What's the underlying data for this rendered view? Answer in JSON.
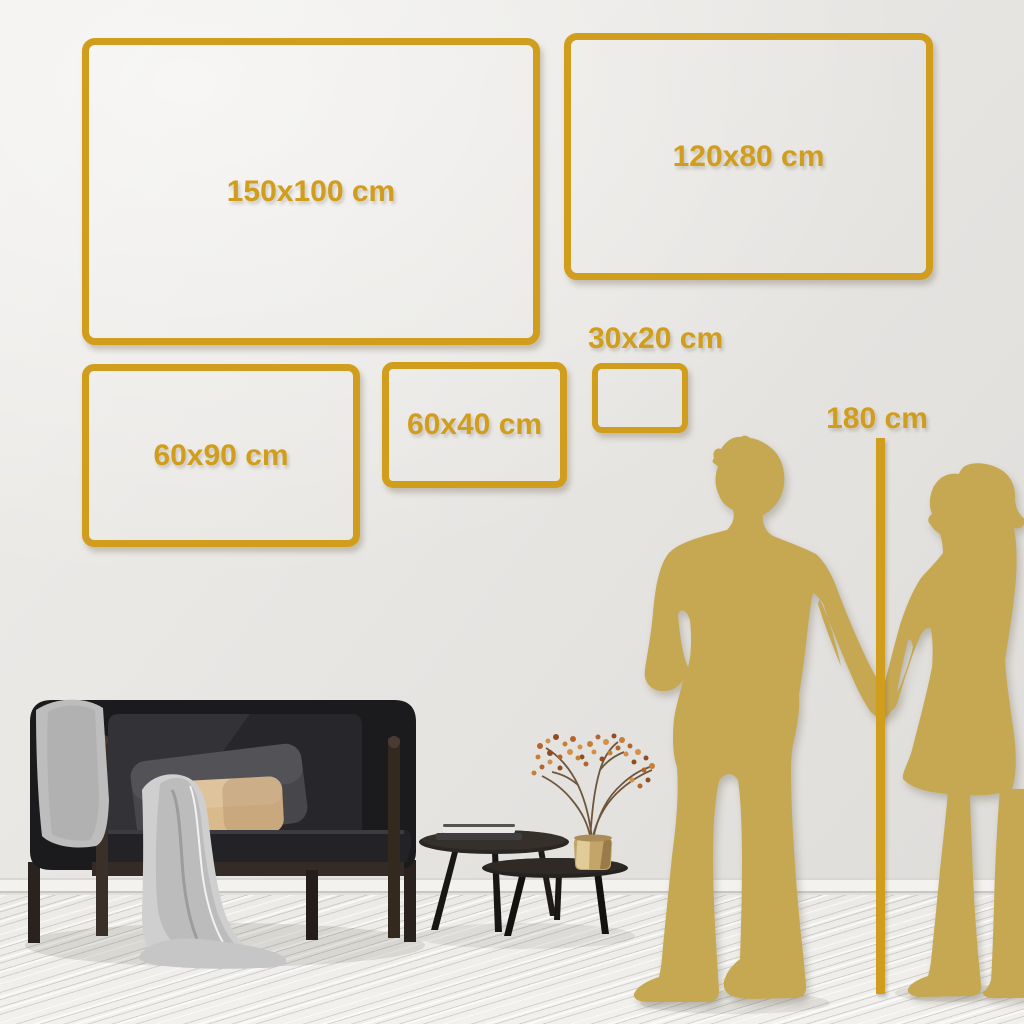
{
  "frames": [
    {
      "id": "150x100",
      "label": "150x100 cm"
    },
    {
      "id": "120x80",
      "label": "120x80 cm"
    },
    {
      "id": "30x20",
      "label": "30x20 cm"
    },
    {
      "id": "60x40",
      "label": "60x40 cm"
    },
    {
      "id": "60x90",
      "label": "60x90 cm"
    }
  ],
  "height_reference": {
    "label": "180 cm"
  },
  "colors": {
    "frame_gold": "#D19D1C",
    "silhouette_gold": "#C6A853",
    "wall": "#E8E6E3",
    "floor": "#F0EFEC"
  },
  "scene": {
    "figures": [
      "man-silhouette",
      "woman-silhouette"
    ],
    "furniture": [
      "sofa",
      "throw-blanket",
      "back-pillow",
      "lumbar-pillow",
      "coffee-table-large",
      "coffee-table-small",
      "books",
      "brass-vase",
      "dried-branch-plant"
    ]
  }
}
